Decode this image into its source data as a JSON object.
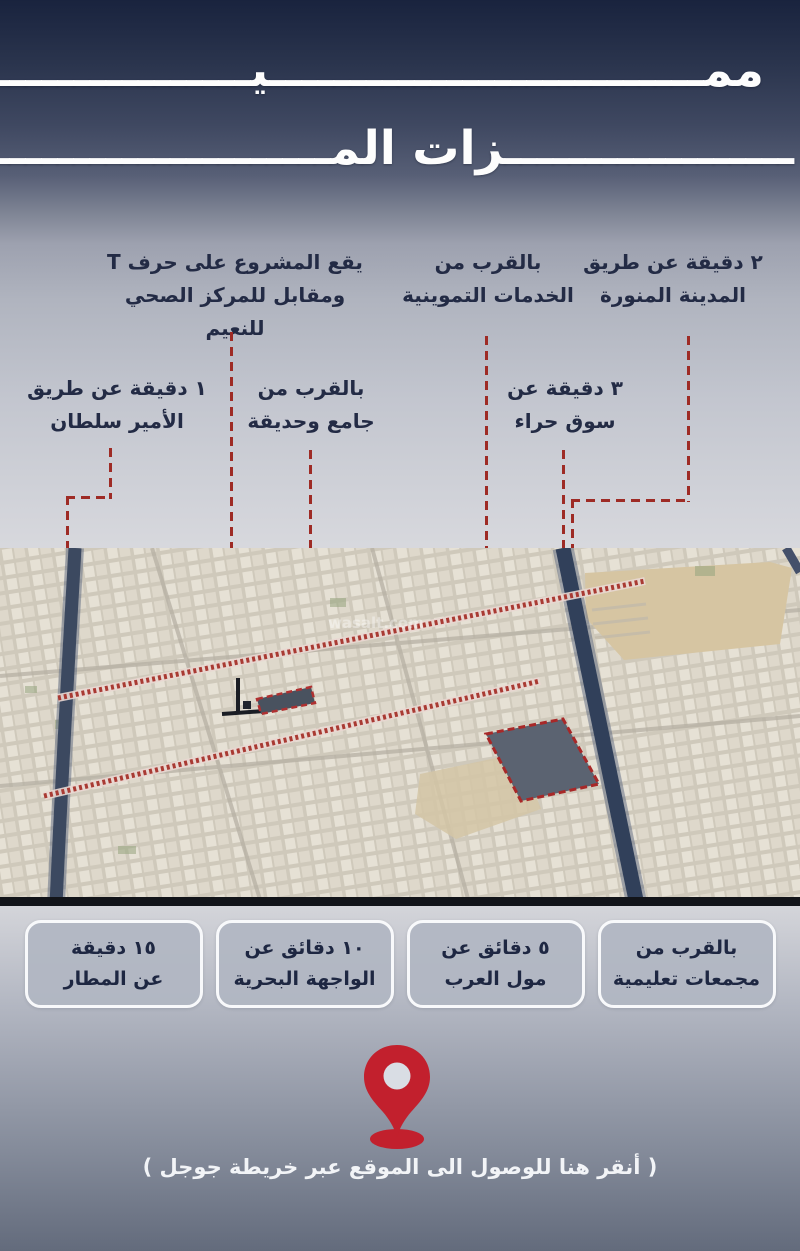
{
  "title": {
    "line1": "ممـــــــــــــــــــــــــــيـــــــــــــــــــــــــــــ",
    "line2": "ــــــــــــــــــزات المـــــــــــــــــــــــوقع"
  },
  "callouts": [
    {
      "id": "madinah-road",
      "line1": "٢ دقيقة عن طريق",
      "line2": "المدينة المنورة"
    },
    {
      "id": "supply-services",
      "line1": "بالقرب من",
      "line2": "الخدمات التموينية"
    },
    {
      "id": "project-position",
      "line1": "يقع المشروع على حرف T",
      "line2": "ومقابل للمركز الصحي للنعيم"
    },
    {
      "id": "prince-sultan-road",
      "line1": "١ دقيقة عن طريق",
      "line2": "الأمير سلطان"
    },
    {
      "id": "mosque-park",
      "line1": "بالقرب من",
      "line2": "جامع وحديقة"
    },
    {
      "id": "hira-market",
      "line1": "٣ دقيقة عن",
      "line2": "سوق حراء"
    }
  ],
  "map": {
    "watermark": "wasalt.com"
  },
  "badges": [
    {
      "id": "educational-complexes",
      "line1": "بالقرب من",
      "line2": "مجمعات تعليمية"
    },
    {
      "id": "mall-of-arabia",
      "line1": "٥ دقائق عن",
      "line2": "مول العرب"
    },
    {
      "id": "waterfront",
      "line1": "١٠ دقائق عن",
      "line2": "الواجهة البحرية"
    },
    {
      "id": "airport",
      "line1": "١٥ دقيقة",
      "line2": "عن المطار"
    }
  ],
  "footer": {
    "cta": "( أنقر هنا للوصول الى الموقع عبر خريطة جوجل )"
  },
  "colors": {
    "accent_red": "#9e2b25",
    "pin_red": "#c2202d",
    "text_navy": "#232b45",
    "header_navy": "#19233e"
  }
}
